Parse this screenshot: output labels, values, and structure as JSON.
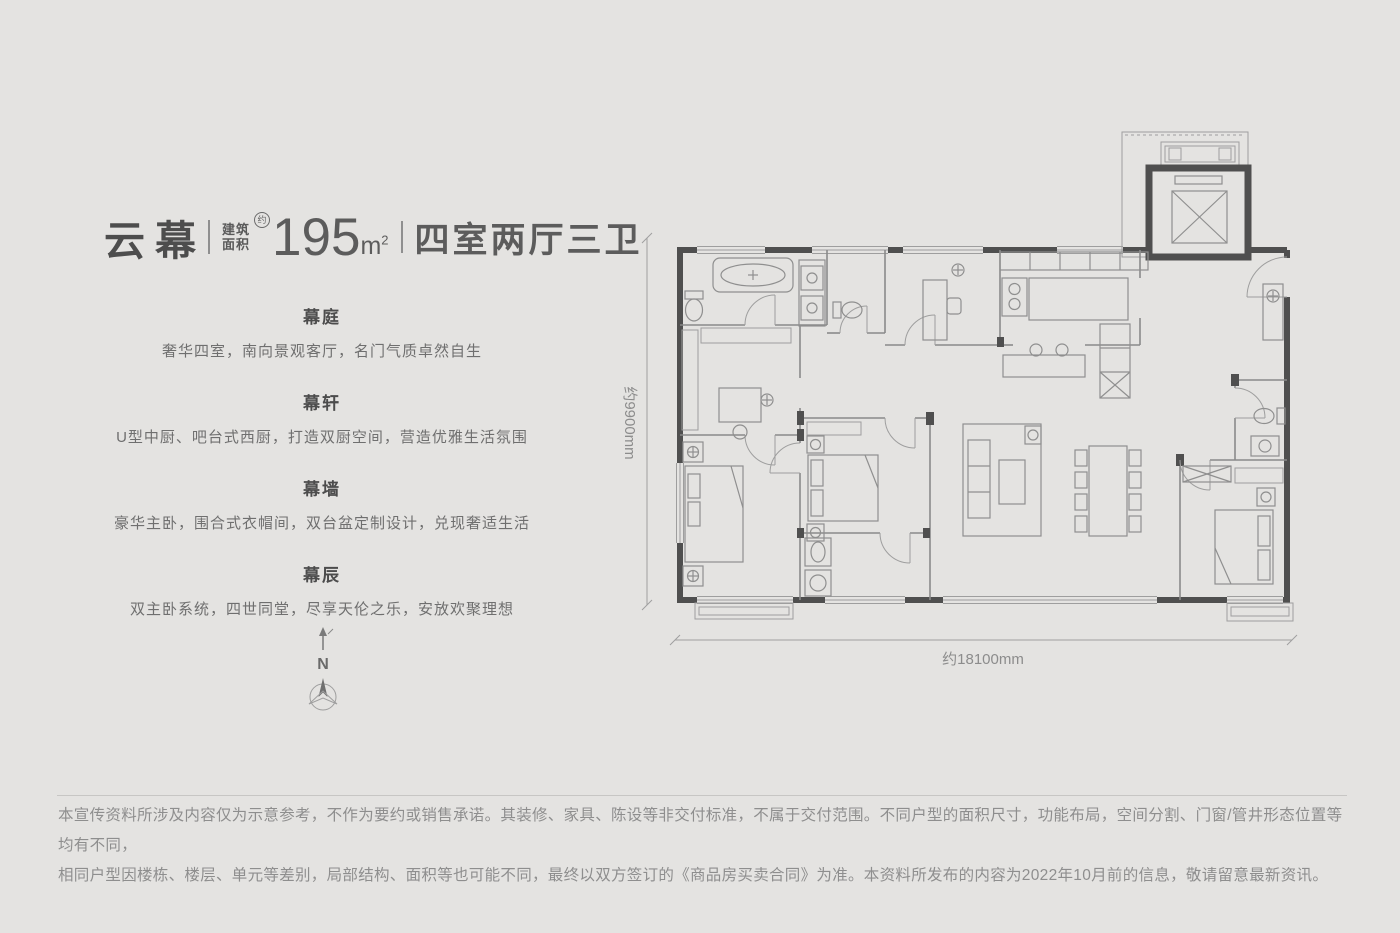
{
  "title_block": {
    "series_name": "云幕",
    "area_label_l1": "建筑",
    "area_label_l2": "面积",
    "area_approx_mark": "约",
    "area_value": "195",
    "area_unit_letter": "m",
    "area_unit_sup": "2",
    "layout_spec": "四室两厅三卫"
  },
  "features": [
    {
      "title": "幕庭",
      "desc": "奢华四室，南向景观客厅，名门气质卓然自生"
    },
    {
      "title": "幕轩",
      "desc": "U型中厨、吧台式西厨，打造双厨空间，营造优雅生活氛围"
    },
    {
      "title": "幕墙",
      "desc": "豪华主卧，围合式衣帽间，双台盆定制设计，兑现奢适生活"
    },
    {
      "title": "幕辰",
      "desc": "双主卧系统，四世同堂，尽享天伦之乐，安放欢聚理想"
    }
  ],
  "compass": {
    "north_label": "N"
  },
  "floorplan": {
    "width_dimension": "约18100mm",
    "depth_dimension": "约9900mm"
  },
  "disclaimer": {
    "line1": "本宣传资料所涉及内容仅为示意参考，不作为要约或销售承诺。其装修、家具、陈设等非交付标准，不属于交付范围。不同户型的面积尺寸，功能布局，空间分割、门窗/管井形态位置等均有不同，",
    "line2": "相同户型因楼栋、楼层、单元等差别，局部结构、面积等也可能不同，最终以双方签订的《商品房买卖合同》为准。本资料所发布的内容为2022年10月前的信息，敬请留意最新资讯。"
  },
  "colors": {
    "background": "#e4e3e1",
    "wall": "#4f4f4f",
    "plan_line": "#8f8f8f",
    "text_dark": "#4d4d4d",
    "text_body": "#6f6f6f",
    "text_muted": "#8e8e8e"
  }
}
